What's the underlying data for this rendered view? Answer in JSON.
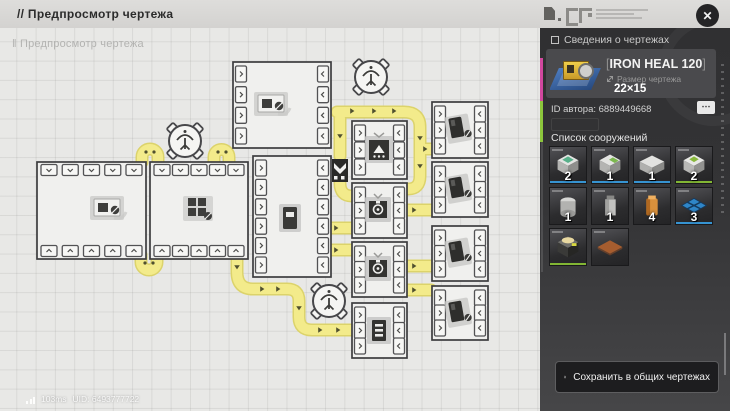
{
  "window": {
    "close_label": "✕"
  },
  "top_bar": {
    "title": "// Предпросмотр чертежа"
  },
  "canvas": {
    "watermark": "‖ Предпросмотр чертежа"
  },
  "status_bar": {
    "ping": "103ms",
    "uid": "UID: 6493777722"
  },
  "panel": {
    "section_title": "Сведения о чертежах",
    "blueprint": {
      "bracket_left": "[",
      "name": "IRON HEAL 120",
      "bracket_right": "]",
      "size_label": "Размер чертежа",
      "size_value": "22×15"
    },
    "author_id": "ID автора: 6889449668",
    "more_label": "⋯",
    "structures_title": "Список сооружений",
    "structures": [
      {
        "icon": "assembler-machine",
        "count": "2",
        "edge": "blue"
      },
      {
        "icon": "press-machine",
        "count": "1",
        "edge": "blue"
      },
      {
        "icon": "refiner-machine",
        "count": "1",
        "edge": "blue"
      },
      {
        "icon": "processor-machine",
        "count": "2",
        "edge": "green"
      },
      {
        "icon": "storage-silo",
        "count": "1",
        "edge": "none"
      },
      {
        "icon": "storage-tower",
        "count": "1",
        "edge": "none"
      },
      {
        "icon": "fluid-canister",
        "count": "4",
        "edge": "none"
      },
      {
        "icon": "platform-tile",
        "count": "3",
        "edge": "blue"
      },
      {
        "icon": "power-unit",
        "count": "",
        "edge": "green"
      },
      {
        "icon": "foundation-pad",
        "count": "",
        "edge": "none"
      }
    ],
    "save_button_label": "Сохранить в общих чертежах"
  }
}
